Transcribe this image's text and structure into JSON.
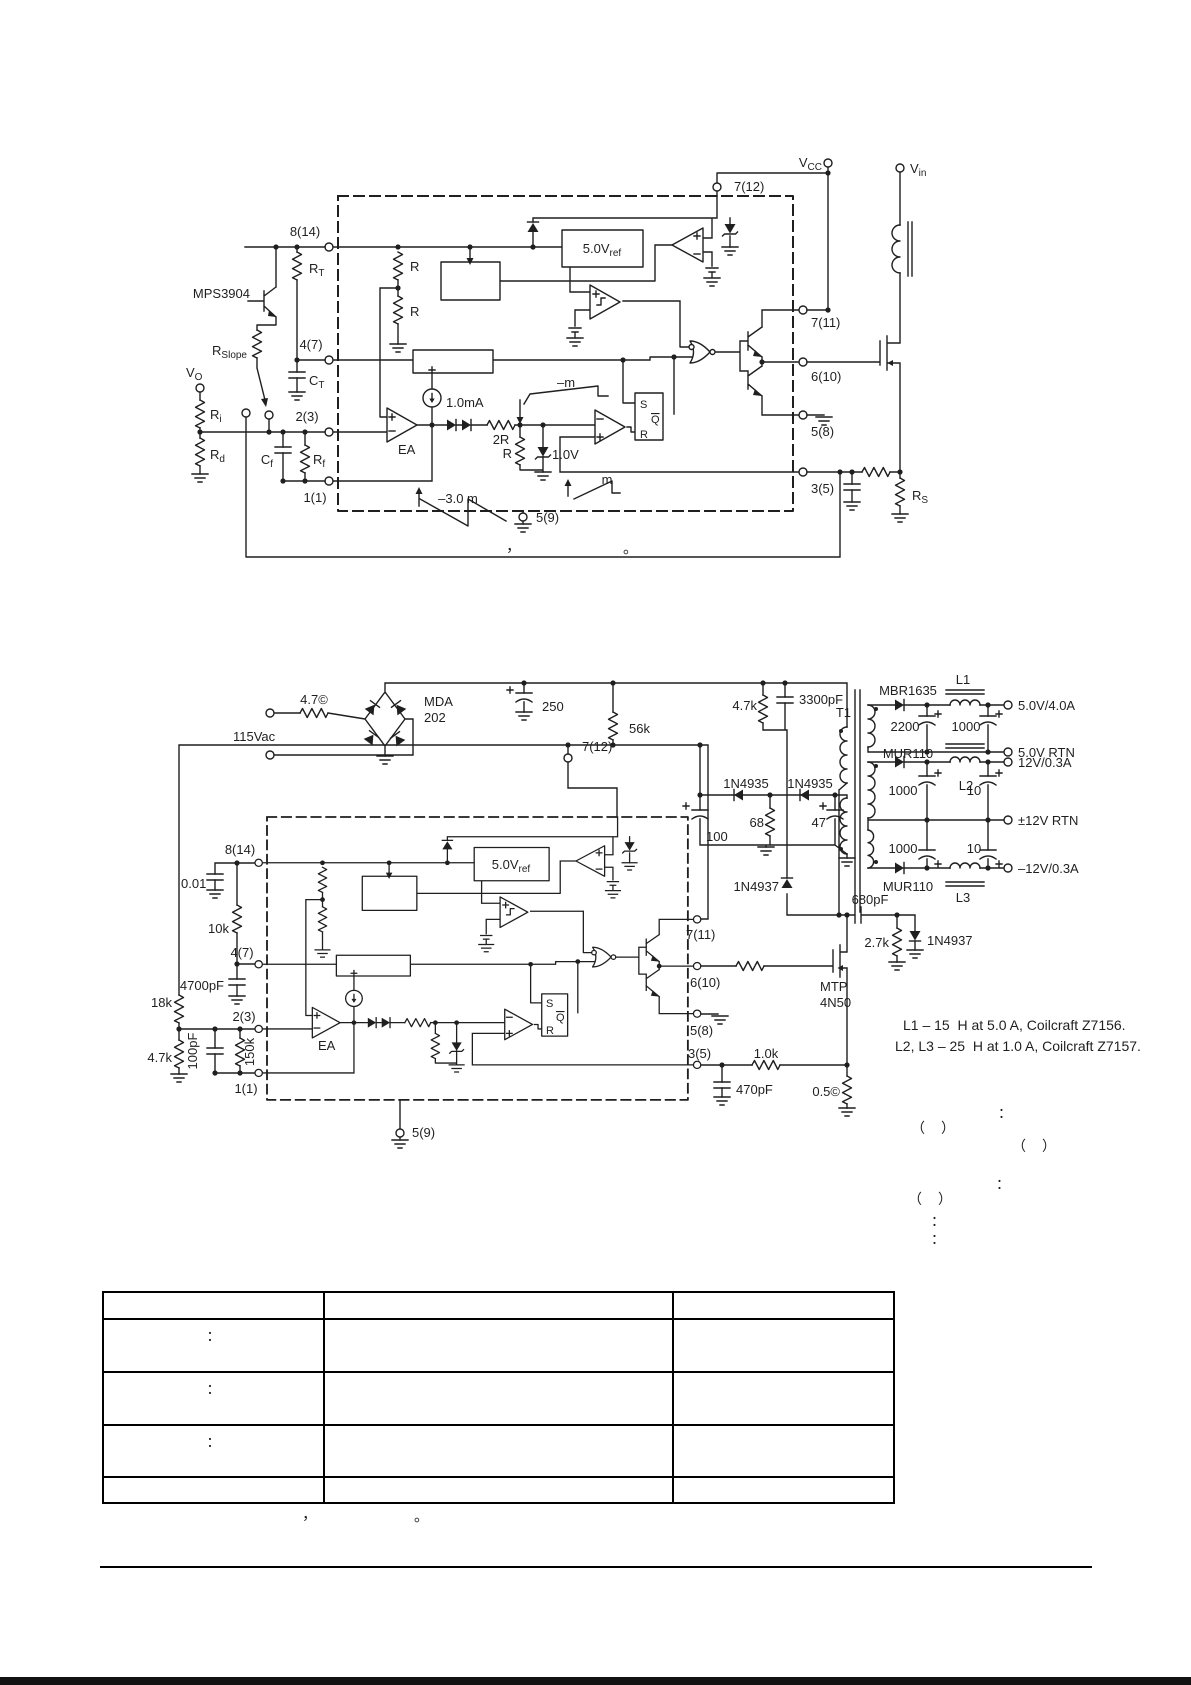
{
  "figure1": {
    "pins": {
      "p8": "8(14)",
      "p4": "4(7)",
      "p2": "2(3)",
      "p1": "1(1)",
      "p59": "5(9)",
      "p712": "7(12)",
      "p711": "7(11)",
      "p610": "6(10)",
      "p58": "5(8)",
      "p35": "3(5)"
    },
    "labels": {
      "vcc": {
        "base": "V",
        "sub": "CC"
      },
      "vin": {
        "base": "V",
        "sub": "in"
      },
      "rt": {
        "base": "R",
        "sub": "T"
      },
      "ct": {
        "base": "C",
        "sub": "T"
      },
      "rslope": {
        "base": "R",
        "sub": "Slope"
      },
      "vo": {
        "base": "V",
        "sub": "O"
      },
      "ri": {
        "base": "R",
        "sub": "i"
      },
      "rd": {
        "base": "R",
        "sub": "d"
      },
      "cf": {
        "base": "C",
        "sub": "f"
      },
      "rf": {
        "base": "R",
        "sub": "f"
      },
      "rs": {
        "base": "R",
        "sub": "S"
      },
      "vref": {
        "base": "5.0V",
        "sub": "ref"
      },
      "mps": "MPS3904",
      "r_div_top": "R",
      "r_div_bot": "R",
      "ea": "EA",
      "isrc": "1.0mA",
      "r2r": "2R",
      "r": "R",
      "zener": "1.0V",
      "neg_m": "–m",
      "m": "m",
      "neg_3m": "–3.0 m",
      "latch_s": "S",
      "latch_r": "R",
      "latch_q": "Q"
    },
    "caption": {
      "comma": "，",
      "period": "。"
    }
  },
  "figure2": {
    "pins": {
      "p8": "8(14)",
      "p4": "4(7)",
      "p2": "2(3)",
      "p1": "1(1)",
      "p59": "5(9)",
      "p712": "7(12)",
      "p711": "7(11)",
      "p610": "6(10)",
      "p58": "5(8)",
      "p35": "3(5)"
    },
    "labels": {
      "vac": "115Vac",
      "fuse": "4.7©",
      "bridge1": "MDA",
      "bridge2": "202",
      "c_bulk": "250",
      "r_start": "56k",
      "r_clamp": "4.7k",
      "c_clamp": "3300pF",
      "t1": "T1",
      "d_5v": "MBR1635",
      "l1": "L1",
      "out_5v": "5.0V/4.0A",
      "c2200": "2200",
      "c1000_5v": "1000",
      "rtn_5v": "5.0V RTN",
      "d_12v": "MUR110",
      "l2": "L2",
      "out_12v": "12V/0.3A",
      "c1000_12v": "1000",
      "c10_12v": "10",
      "rtn_12v": "±12V RTN",
      "c1000_n12v": "1000",
      "c10_n12v": "10",
      "d_n12v": "MUR110",
      "l3": "L3",
      "out_n12v": "–12V/0.3A",
      "d_aux1": "1N4935",
      "d_aux2": "1N4935",
      "c100": "100",
      "r68": "68",
      "c47": "47",
      "d_clamp": "1N4937",
      "c680": "680pF",
      "r27": "2.7k",
      "d_gate": "1N4937",
      "q1a": "MTP",
      "q1b": "4N50",
      "r1k": "1.0k",
      "c470": "470pF",
      "r_sense": "0.5©",
      "c001": "0.01",
      "r10k": "10k",
      "c4700": "4700pF",
      "r18k": "18k",
      "r47k": "4.7k",
      "c100p": "100pF",
      "r150k": "150k",
      "ea": "EA",
      "vref": {
        "base": "5.0V",
        "sub": "ref"
      },
      "latch_s": "S",
      "latch_r": "R",
      "latch_q": "Q"
    },
    "coilcraft": [
      "L1 – 15  H at 5.0 A, Coilcraft Z7156.",
      "L2, L3 – 25  H at 1.0 A, Coilcraft Z7157."
    ],
    "notes": {
      "colon": "：",
      "parens": "（　）"
    }
  },
  "table": {
    "rows": [
      [
        "",
        "",
        ""
      ],
      [
        "：",
        "",
        ""
      ],
      [
        "：",
        "",
        ""
      ],
      [
        "：",
        "",
        ""
      ],
      [
        "",
        "",
        ""
      ]
    ],
    "caption": {
      "comma": "，",
      "period": "。"
    }
  }
}
